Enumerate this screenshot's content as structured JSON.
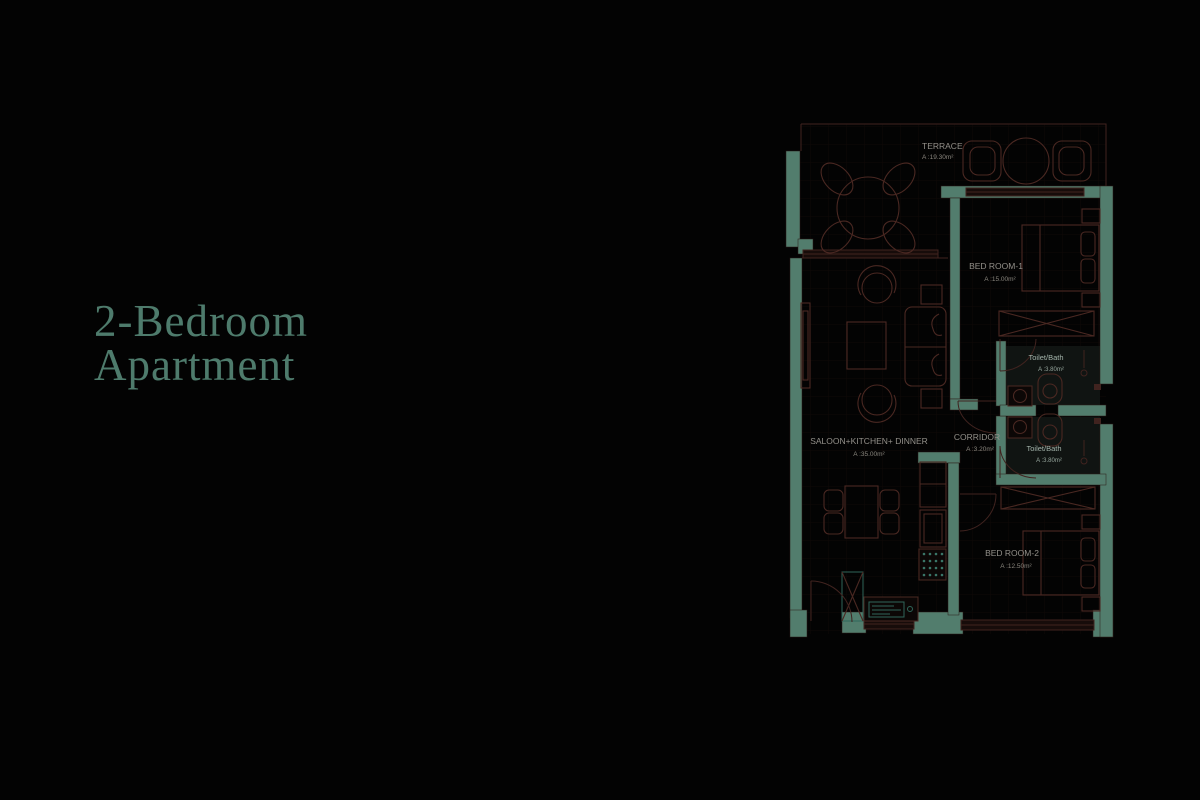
{
  "title": {
    "line1": "2-Bedroom",
    "line2": "Apartment"
  },
  "colors": {
    "background": "#030303",
    "title_text": "#4e7b6c",
    "wall_fill": "#527d6d",
    "wall_outline": "#40231f",
    "furniture_outline": "#4a2822",
    "window_fill": "#170c0a",
    "room_label": "#93908a",
    "bath_label": "#a4b4ab",
    "kitchen_accent": "#2f665a"
  },
  "floor_plan": {
    "rooms": [
      {
        "id": "terrace",
        "name": "TERRACE",
        "area": "A :19.30m²"
      },
      {
        "id": "bedroom-1",
        "name": "BED ROOM-1",
        "area": "A :15.00m²"
      },
      {
        "id": "toilet-bath-1",
        "name": "Toilet/Bath",
        "area": "A :3.80m²"
      },
      {
        "id": "corridor",
        "name": "CORRIDOR",
        "area": "A :3.20m²"
      },
      {
        "id": "toilet-bath-2",
        "name": "Toilet/Bath",
        "area": "A :3.80m²"
      },
      {
        "id": "saloon-kitchen-dinner",
        "name": "SALOON+KITCHEN+ DINNER",
        "area": "A :35.00m²"
      },
      {
        "id": "bedroom-2",
        "name": "BED ROOM-2",
        "area": "A :12.50m²"
      }
    ],
    "furniture": [
      "round-dining-table",
      "terrace-lounge-chair",
      "terrace-side-table",
      "tv-unit",
      "armchair",
      "coffee-table",
      "sofa",
      "side-table",
      "dining-table",
      "dining-chair",
      "tall-cabinet",
      "kitchen-sink-counter",
      "stove",
      "fridge-cabinet",
      "double-bed",
      "pillow",
      "nightstand",
      "wardrobe",
      "wash-basin",
      "toilet",
      "shower-fixture",
      "door"
    ]
  }
}
